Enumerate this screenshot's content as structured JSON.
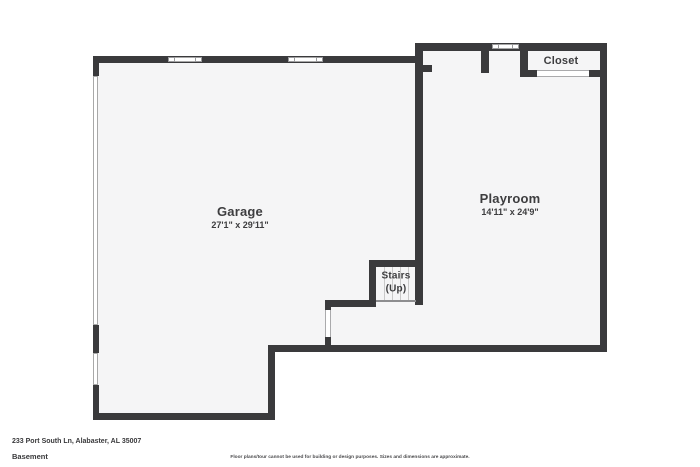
{
  "rooms": {
    "garage": {
      "name": "Garage",
      "dimensions": "27'1\" x 29'11\""
    },
    "playroom": {
      "name": "Playroom",
      "dimensions": "14'11\" x 24'9\""
    },
    "closet": {
      "name": "Closet"
    },
    "stairs": {
      "name": "Stairs",
      "direction": "(Up)"
    }
  },
  "footer": {
    "address": "233 Port South Ln, Alabaster, AL 35007",
    "floor_label": "Basement",
    "disclaimer": "Floor plans/tour cannot be used for building or design purposes. Sizes and dimensions are approximate."
  },
  "colors": {
    "wall": "#3a3a3c",
    "floor": "#f5f5f6",
    "background": "#ffffff"
  }
}
